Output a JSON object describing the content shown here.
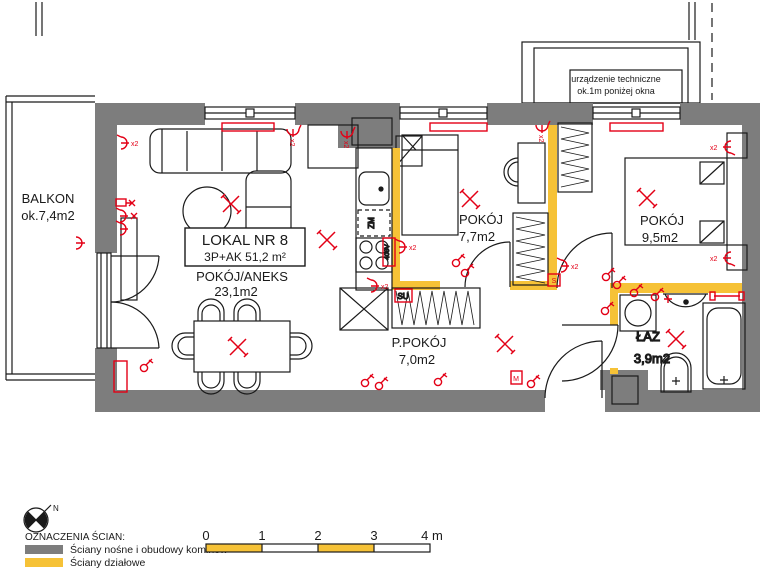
{
  "plan": {
    "unit": {
      "name": "LOKAL NR 8",
      "type_area": "3P+AK  51,2 m²"
    },
    "rooms": {
      "balkon": {
        "name": "BALKON",
        "area": "ok.7,4m2"
      },
      "aneks": {
        "name": "POKÓJ/ANEKS",
        "area": "23,1m2"
      },
      "pokoj1": {
        "name": "POKÓJ",
        "area": "7,7m2"
      },
      "pokoj2": {
        "name": "POKÓJ",
        "area": "9,5m2"
      },
      "ppokoj": {
        "name": "P.POKÓJ",
        "area": "7,0m2"
      },
      "laz": {
        "name": "ŁAZ",
        "area": "3,9m2"
      }
    },
    "notes": {
      "tech1": "urządzenie techniczne",
      "tech2": "ok.1m poniżej okna",
      "zm": "ZM",
      "v400": "400V",
      "su": "SU",
      "x2": "x2",
      "s": "S",
      "m": "M"
    }
  },
  "legend": {
    "north": "N",
    "title": "OZNACZENIA ŚCIAN:",
    "items": [
      {
        "label": "Ściany nośne i obudowy kominów",
        "color": "#7d7d7d"
      },
      {
        "label": "Ściany działowe",
        "color": "#f6c237"
      }
    ]
  },
  "scalebar": {
    "ticks": [
      "0",
      "1",
      "2",
      "3",
      "4 m"
    ]
  },
  "colors": {
    "wall_gray": "#7d7d7d",
    "wall_yellow": "#f6c237",
    "symbol_red": "#e30016"
  }
}
